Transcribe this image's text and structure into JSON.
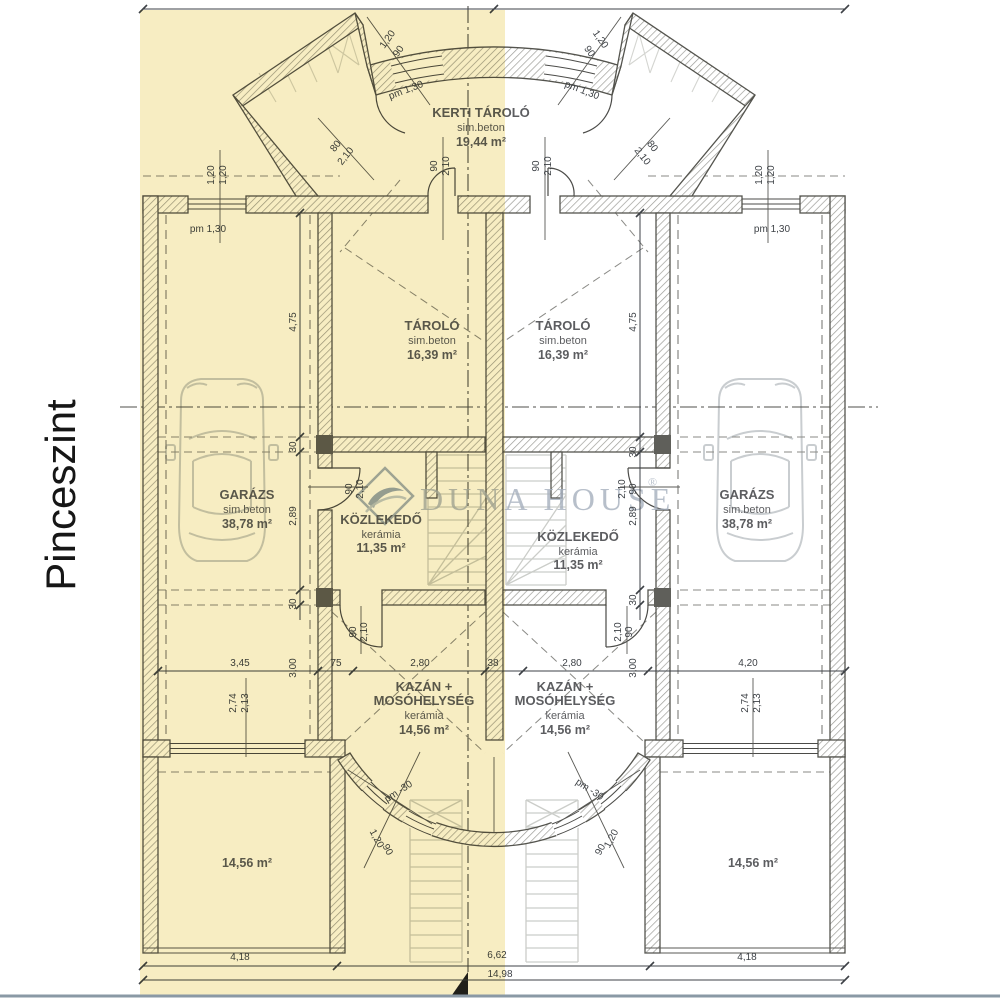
{
  "floor_label": "Pinceszint",
  "watermark": {
    "brand": "DUNA HOUSE",
    "registered": "®"
  },
  "rooms": {
    "kerti_tarolo": {
      "name": "KERTI TÁROLÓ",
      "material": "sim.beton",
      "area": "19,44 m²"
    },
    "tarolo_left": {
      "name": "TÁROLÓ",
      "material": "sim.beton",
      "area": "16,39 m²"
    },
    "tarolo_right": {
      "name": "TÁROLÓ",
      "material": "sim.beton",
      "area": "16,39 m²"
    },
    "garazs_left": {
      "name": "GARÁZS",
      "material": "sim.beton",
      "area": "38,78 m²"
    },
    "garazs_right": {
      "name": "GARÁZS",
      "material": "sim.beton",
      "area": "38,78 m²"
    },
    "kozlekedo_left": {
      "name": "KÖZLEKEDŐ",
      "material": "kerámia",
      "area": "11,35 m²"
    },
    "kozlekedo_right": {
      "name": "KÖZLEKEDŐ",
      "material": "kerámia",
      "area": "11,35 m²"
    },
    "kazan_left": {
      "name": "KAZÁN +",
      "name2": "MOSÓHELYSÉG",
      "material": "kerámia",
      "area": "14,56 m²"
    },
    "kazan_right": {
      "name": "KAZÁN +",
      "name2": "MOSÓHELYSÉG",
      "material": "kerámia",
      "area": "14,56 m²"
    },
    "room_bottom_left": {
      "area": "14,56 m²"
    },
    "room_bottom_right": {
      "area": "14,56 m²"
    }
  },
  "dimension_labels": [
    {
      "t": "4,18",
      "x": 240,
      "y": 960,
      "r": 0
    },
    {
      "t": "6,62",
      "x": 497,
      "y": 958,
      "r": 0
    },
    {
      "t": "4,18",
      "x": 747,
      "y": 960,
      "r": 0
    },
    {
      "t": "14,98",
      "x": 500,
      "y": 977,
      "r": 0
    },
    {
      "t": "3,45",
      "x": 240,
      "y": 666,
      "r": 0
    },
    {
      "t": "75",
      "x": 336,
      "y": 666,
      "r": 0
    },
    {
      "t": "2,80",
      "x": 420,
      "y": 666,
      "r": 0
    },
    {
      "t": "38",
      "x": 493,
      "y": 666,
      "r": 0
    },
    {
      "t": "2,80",
      "x": 572,
      "y": 666,
      "r": 0
    },
    {
      "t": "4,20",
      "x": 748,
      "y": 666,
      "r": 0
    },
    {
      "t": "3,00",
      "x": 296,
      "y": 668,
      "r": -90
    },
    {
      "t": "3,00",
      "x": 636,
      "y": 668,
      "r": -90
    },
    {
      "t": "2,74",
      "x": 236,
      "y": 703,
      "r": -90
    },
    {
      "t": "2,13",
      "x": 248,
      "y": 703,
      "r": -90
    },
    {
      "t": "2,74",
      "x": 748,
      "y": 703,
      "r": -90
    },
    {
      "t": "2,13",
      "x": 760,
      "y": 703,
      "r": -90
    },
    {
      "t": "4,75",
      "x": 296,
      "y": 322,
      "r": -90
    },
    {
      "t": "4,75",
      "x": 636,
      "y": 322,
      "r": -90
    },
    {
      "t": "30",
      "x": 296,
      "y": 447,
      "r": -90
    },
    {
      "t": "30",
      "x": 636,
      "y": 452,
      "r": -90
    },
    {
      "t": "2,89",
      "x": 296,
      "y": 516,
      "r": -90
    },
    {
      "t": "2,89",
      "x": 636,
      "y": 516,
      "r": -90
    },
    {
      "t": "30",
      "x": 296,
      "y": 604,
      "r": -90
    },
    {
      "t": "30",
      "x": 636,
      "y": 600,
      "r": -90
    },
    {
      "t": "pm 1,30",
      "x": 208,
      "y": 232,
      "r": 0
    },
    {
      "t": "pm 1,30",
      "x": 772,
      "y": 232,
      "r": 0
    },
    {
      "t": "1,20",
      "x": 214,
      "y": 175,
      "r": -90
    },
    {
      "t": "1,20",
      "x": 226,
      "y": 175,
      "r": -90
    },
    {
      "t": "1,20",
      "x": 762,
      "y": 175,
      "r": -90
    },
    {
      "t": "1,20",
      "x": 774,
      "y": 175,
      "r": -90
    },
    {
      "t": "90",
      "x": 437,
      "y": 166,
      "r": -90
    },
    {
      "t": "2,10",
      "x": 449,
      "y": 166,
      "r": -90
    },
    {
      "t": "90",
      "x": 539,
      "y": 166,
      "r": -90
    },
    {
      "t": "2,10",
      "x": 551,
      "y": 166,
      "r": -90
    },
    {
      "t": "90",
      "x": 352,
      "y": 489,
      "r": -90
    },
    {
      "t": "2,10",
      "x": 363,
      "y": 489,
      "r": -90
    },
    {
      "t": "90",
      "x": 636,
      "y": 489,
      "r": -90
    },
    {
      "t": "2,10",
      "x": 625,
      "y": 489,
      "r": -90
    },
    {
      "t": "90",
      "x": 356,
      "y": 632,
      "r": -90
    },
    {
      "t": "2,10",
      "x": 367,
      "y": 632,
      "r": -90
    },
    {
      "t": "90",
      "x": 632,
      "y": 632,
      "r": -90
    },
    {
      "t": "2,10",
      "x": 621,
      "y": 632,
      "r": -90
    },
    {
      "t": "pm 1,30",
      "x": 407,
      "y": 93,
      "r": -21
    },
    {
      "t": "pm 1,30",
      "x": 581,
      "y": 93,
      "r": 21
    },
    {
      "t": "1,20",
      "x": 390,
      "y": 41,
      "r": -55
    },
    {
      "t": "90",
      "x": 401,
      "y": 53,
      "r": -55
    },
    {
      "t": "1,20",
      "x": 598,
      "y": 41,
      "r": 55
    },
    {
      "t": "90",
      "x": 587,
      "y": 53,
      "r": 55
    },
    {
      "t": "80",
      "x": 338,
      "y": 148,
      "r": -52
    },
    {
      "t": "2,10",
      "x": 348,
      "y": 158,
      "r": -52
    },
    {
      "t": "80",
      "x": 650,
      "y": 148,
      "r": 52
    },
    {
      "t": "2,10",
      "x": 640,
      "y": 158,
      "r": 52
    },
    {
      "t": "pm -30",
      "x": 400,
      "y": 794,
      "r": -33
    },
    {
      "t": "pm -30",
      "x": 588,
      "y": 792,
      "r": 33
    },
    {
      "t": "1,20",
      "x": 374,
      "y": 840,
      "r": 62
    },
    {
      "t": "90",
      "x": 385,
      "y": 851,
      "r": 62
    },
    {
      "t": "1,20",
      "x": 614,
      "y": 840,
      "r": -62
    },
    {
      "t": "90",
      "x": 603,
      "y": 851,
      "r": -62
    }
  ]
}
